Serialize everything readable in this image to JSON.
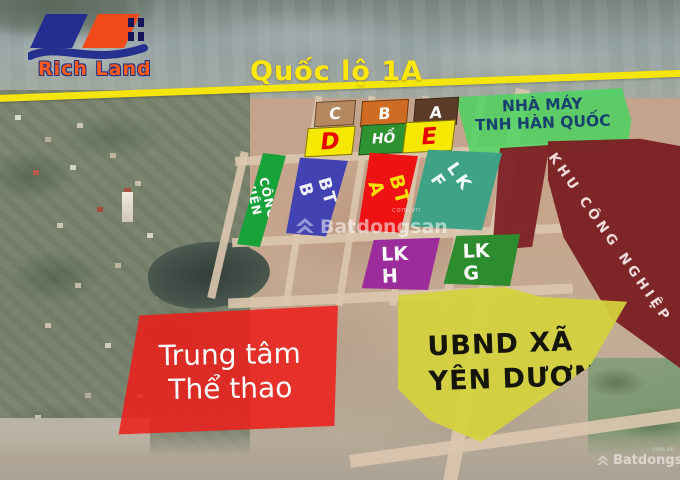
{
  "brand": {
    "name": "Rich Land"
  },
  "road": {
    "label": "Quốc lộ 1A",
    "line_color": "#f4e50c"
  },
  "plots": {
    "c": {
      "label": "C",
      "color": "#b5885f"
    },
    "b": {
      "label": "B",
      "color": "#cf6b22"
    },
    "a": {
      "label": "A",
      "color": "#5c3b28"
    },
    "d": {
      "label": "D",
      "color": "#f6e800",
      "text_color": "#e60000"
    },
    "ho": {
      "label": "HỒ",
      "color": "#2e9231"
    },
    "e": {
      "label": "E",
      "color": "#f6e800",
      "text_color": "#e60000"
    },
    "cong_vien": {
      "label": "CÔNG VIÊN",
      "color": "#18a23a"
    },
    "bt_b": {
      "label": "BT B",
      "color": "#4242b2"
    },
    "bt_a": {
      "label": "BT A",
      "color": "#ee1212",
      "text_color": "#ffe000"
    },
    "lk_f": {
      "label": "LK F",
      "color": "#3fa287"
    },
    "lk_h": {
      "label": "LK H",
      "color": "#9c2c9c"
    },
    "lk_g": {
      "label": "LK G",
      "color": "#2d8c2d"
    }
  },
  "zones": {
    "factory": {
      "line1": "NHÀ MÁY",
      "line2": "TNH HÀN QUỐC",
      "color": "#48d65e"
    },
    "industrial": {
      "label": "KHU CÔNG NGHIỆP",
      "color": "#7a2023"
    },
    "sports_center": {
      "line1": "Trung tâm",
      "line2": "Thể thao",
      "color": "#ee1c1a"
    },
    "ubnd": {
      "line1": "UBND XÃ",
      "line2": "YÊN DƯƠNG",
      "color": "#e9e746"
    }
  },
  "watermark": {
    "name": "Batdongsan",
    "domain": "com.vn"
  }
}
